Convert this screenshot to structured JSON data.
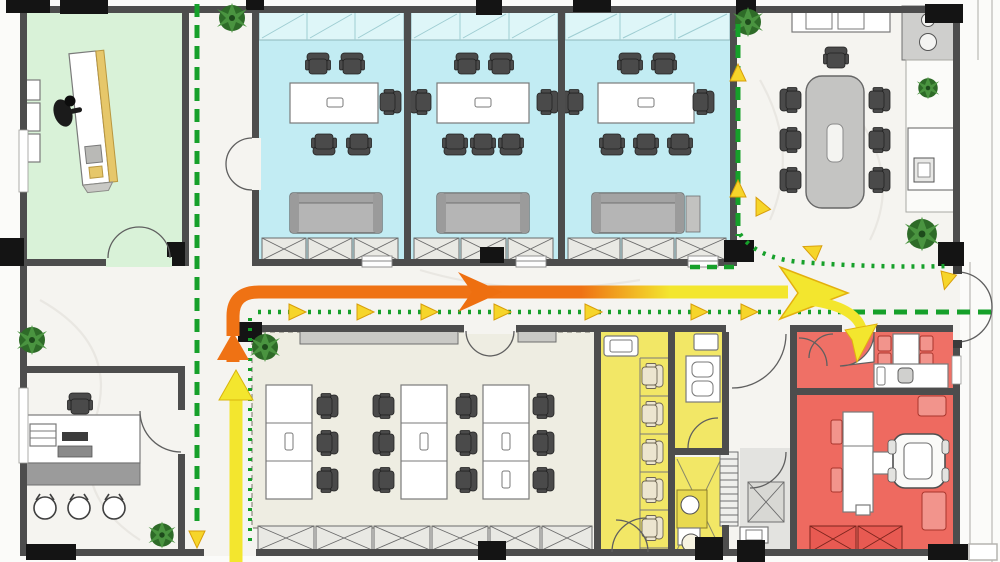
{
  "meta": {
    "title": "Office floor plan with circulation flow diagram",
    "kind": "architectural-floor-plan",
    "canvas": {
      "width": 1000,
      "height": 562
    }
  },
  "colors": {
    "corridor_floor": "#f5f4f0",
    "open_office_floor": "#eeede2",
    "reception_room": "#d9f2d8",
    "meeting_room": "#c2ecf3",
    "glass_partition": "#def6f8",
    "utility_room": "#f2e766",
    "utility_counter": "#e8d94f",
    "red_room": "#ee6a60",
    "red_room_upper": "#ef7066",
    "service_floor": "#e3e3e0",
    "wall": "#4d4d4d",
    "column": "#141414",
    "route_primary_start": "#ef7214",
    "route_primary_end": "#f3e62e",
    "route_arrow_mid": "#ee6f10",
    "route_guide_green": "#16a02a",
    "route_marker_yellow": "#f6d52a",
    "sofa_gray": "#b5b5b5",
    "table_gray": "#c4c4c2",
    "chair_dark": "#4a4a4a",
    "chair_cream": "#ece5cf",
    "plant_dark": "#2e6b28",
    "plant_light": "#4a9440",
    "desk_wood": "#e6c76a"
  },
  "zones": [
    {
      "id": "reception-room",
      "fill_key": "reception_room"
    },
    {
      "id": "meeting-room-1",
      "fill_key": "meeting_room"
    },
    {
      "id": "meeting-room-2",
      "fill_key": "meeting_room"
    },
    {
      "id": "meeting-room-3",
      "fill_key": "meeting_room"
    },
    {
      "id": "open-conference-area",
      "fill_key": "corridor_floor"
    },
    {
      "id": "open-office-area",
      "fill_key": "open_office_floor"
    },
    {
      "id": "private-office",
      "fill_key": "corridor_floor"
    },
    {
      "id": "utility-booth-room",
      "fill_key": "utility_room"
    },
    {
      "id": "utility-room-upper",
      "fill_key": "utility_room"
    },
    {
      "id": "utility-room-lower",
      "fill_key": "utility_room"
    },
    {
      "id": "red-room-upper",
      "fill_key": "red_room_upper"
    },
    {
      "id": "red-room-lower",
      "fill_key": "red_room"
    }
  ],
  "routes": {
    "primary_gradient": [
      "#ef7214",
      "#f3e62e"
    ],
    "guide_style": "dashed-and-dotted-green-with-yellow-arrowheads"
  }
}
